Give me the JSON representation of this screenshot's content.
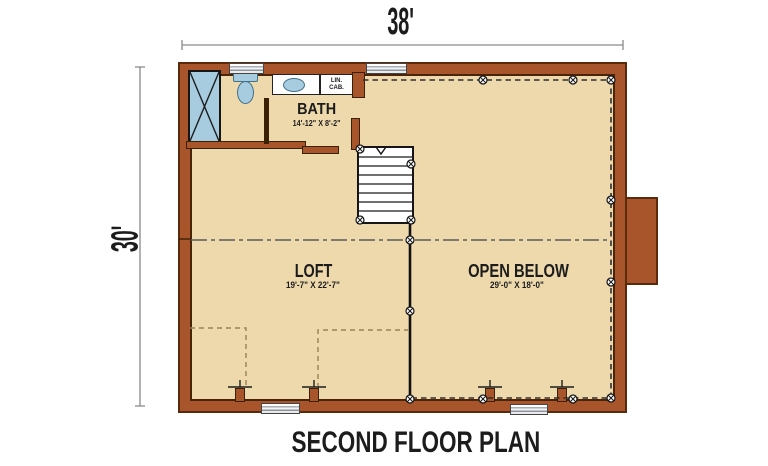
{
  "title": "SECOND FLOOR PLAN",
  "dimensions": {
    "width_label": "38'",
    "height_label": "30'"
  },
  "rooms": {
    "bath": {
      "name": "BATH",
      "size": "14'-12\" X 8'-2\""
    },
    "loft": {
      "name": "LOFT",
      "size": "19'-7\" X 22'-7\""
    },
    "open_below": {
      "name": "OPEN BELOW",
      "size": "29'-0\" X 18'-0\""
    }
  },
  "cabinet_label": {
    "line1": "LIN.",
    "line2": "CAB."
  },
  "colors": {
    "wall": "#a8552b",
    "wall_outline": "#5a2a0d",
    "floor": "#eed9ad",
    "fixture_blue": "#a7cce0",
    "fixture_blue_outline": "#41708c",
    "dash_dark": "#2e2e2e",
    "knee_dash": "#97835a",
    "dim_line": "#8a8a8a",
    "text": "#1c1c1c"
  }
}
